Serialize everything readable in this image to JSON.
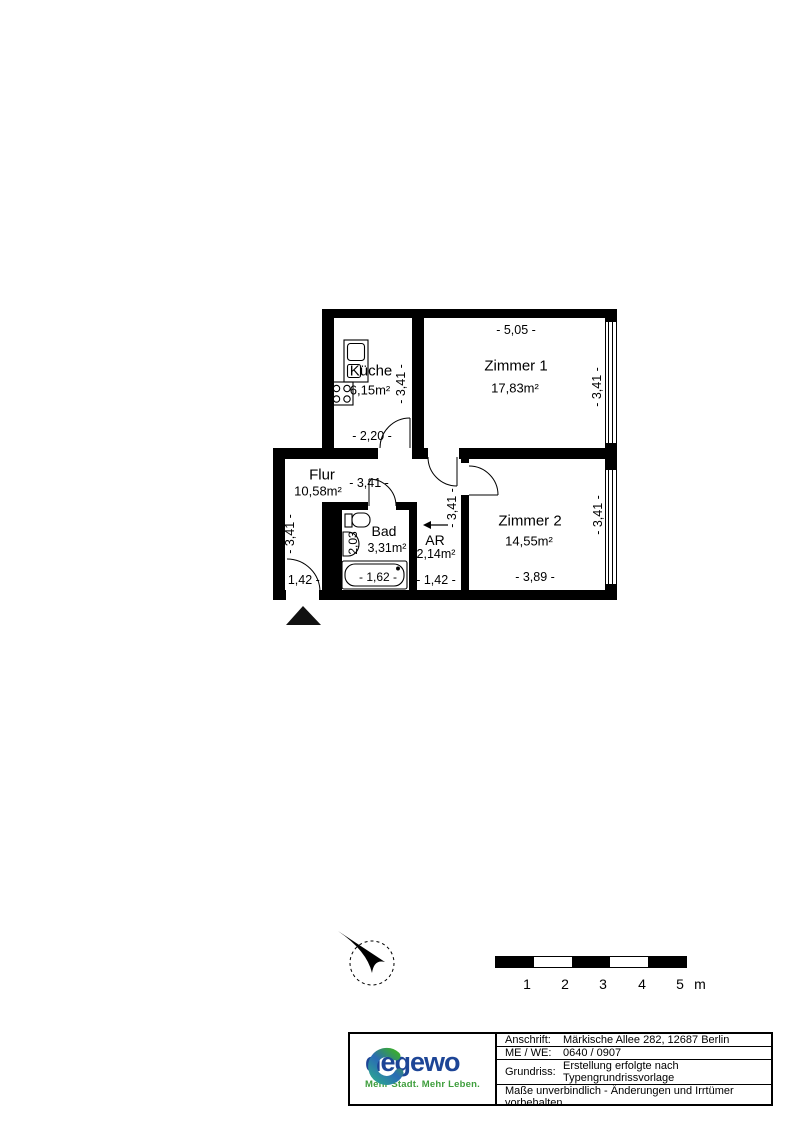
{
  "plan": {
    "rooms": [
      {
        "name": "Küche",
        "area": "6,15m²"
      },
      {
        "name": "Zimmer 1",
        "area": "17,83m²"
      },
      {
        "name": "Flur",
        "area": "10,58m²"
      },
      {
        "name": "Bad",
        "area": "3,31m²"
      },
      {
        "name": "AR",
        "area": "2,14m²"
      },
      {
        "name": "Zimmer 2",
        "area": "14,55m²"
      }
    ],
    "dimensions": {
      "zimmer1_width": "- 5,05 -",
      "zimmer1_depth": "- 3,41 -",
      "kueche_depth": "- 3,41 -",
      "kueche_width": "- 2,20 -",
      "flur_width": "- 3,41 -",
      "flur_depth": "- 3,41 -",
      "entry_width": "- 1,42 -",
      "bad_depth": "2,03",
      "bathtub_length": "- 1,62 -",
      "ar_width": "- 1,42 -",
      "lower_depth": "- 3,41 -",
      "zimmer2_width": "- 3,89 -",
      "zimmer2_depth": "- 3,41 -"
    }
  },
  "scalebar": {
    "ticks": [
      "1",
      "2",
      "3",
      "4",
      "5"
    ],
    "unit": "m"
  },
  "infobox": {
    "rows": [
      {
        "label": "Anschrift:",
        "value": "Märkische Allee 282, 12687 Berlin"
      },
      {
        "label": "ME / WE:",
        "value": "0640 / 0907"
      },
      {
        "label": "Grundriss:",
        "value": "Erstellung erfolgte nach Typengrundrissvorlage"
      }
    ],
    "disclaimer": "Maße unverbindlich - Änderungen und Irrtümer vorbehalten",
    "logo": {
      "name": "degewo",
      "tagline": "Mehr Stadt. Mehr Leben.",
      "colors": {
        "blue": "#2a6bb5",
        "green": "#3aa935",
        "wordmark": "#1d4596"
      }
    }
  }
}
